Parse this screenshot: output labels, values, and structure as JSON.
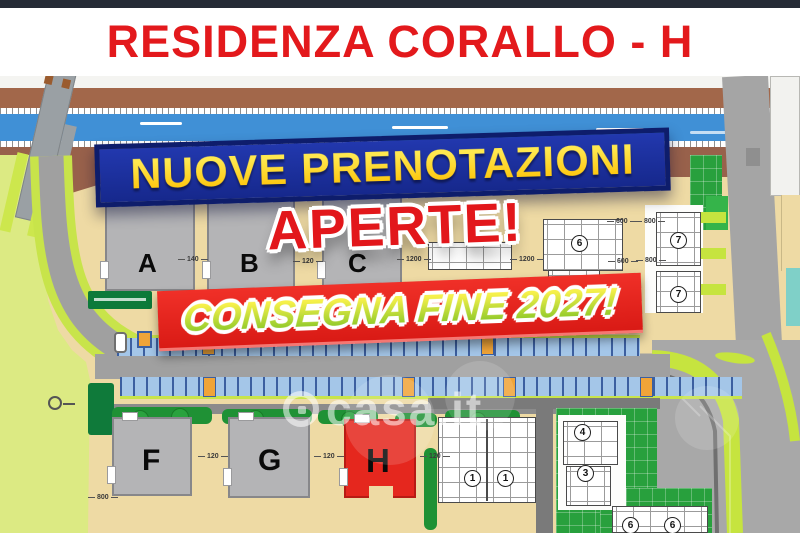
{
  "window": {
    "title": "RESIDENZA CORALLO - H"
  },
  "banners": {
    "new_bookings": "NUOVE PRENOTAZIONI",
    "open": "APERTE!",
    "delivery": "CONSEGNA FINE 2027!"
  },
  "watermark": {
    "brand": "casa.it"
  },
  "buildings": [
    {
      "label": "A"
    },
    {
      "label": "B"
    },
    {
      "label": "C"
    },
    {
      "label": "F"
    },
    {
      "label": "G"
    },
    {
      "label": "H"
    }
  ],
  "plots": [
    {
      "num": "6"
    },
    {
      "num": "7"
    },
    {
      "num": "7"
    },
    {
      "num": "1"
    },
    {
      "num": "1"
    },
    {
      "num": "4"
    },
    {
      "num": "3"
    },
    {
      "num": "6"
    },
    {
      "num": "6"
    }
  ],
  "dimensions": [
    {
      "t": "140"
    },
    {
      "t": "120"
    },
    {
      "t": "1200"
    },
    {
      "t": "1200"
    },
    {
      "t": "600"
    },
    {
      "t": "800"
    },
    {
      "t": "600"
    },
    {
      "t": "800"
    },
    {
      "t": "120"
    },
    {
      "t": "120"
    },
    {
      "t": "120"
    },
    {
      "t": "800"
    }
  ],
  "colors": {
    "title_red": "#e3191c",
    "banner_blue": "#1c2f9c",
    "banner_red": "#e7251f",
    "accent_yellow": "#ffd21e",
    "plan_beige": "#eedaa4",
    "building_gray": "#b4b4b6",
    "highlight_red": "#e5271e",
    "water_blue": "#4090d6",
    "field_green": "#dcea83"
  }
}
